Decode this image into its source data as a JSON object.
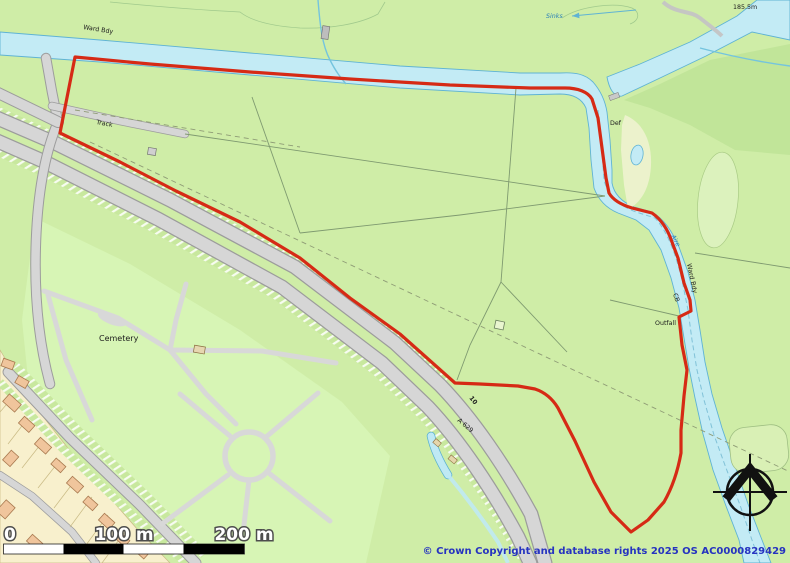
{
  "map": {
    "description": "Ordnance Survey style site plan with red application boundary along River Aire",
    "labels": {
      "ward_bdy_top": "Ward Bdy",
      "track": "Track",
      "sinks": "Sinks",
      "spot_height": "185.5m",
      "def": "Def",
      "river_name": "Aire",
      "ward_bdy_river": "Ward Bdy",
      "cb": "CB",
      "outfall": "Outfall",
      "cemetery": "Cemetery",
      "road_number": "A 629",
      "plot_number": "10"
    },
    "scale_bar": {
      "zero": "0",
      "mid": "100 m",
      "end": "200 m"
    },
    "copyright": "© Crown Copyright and database rights 2025 OS AC0000829429",
    "colors": {
      "field_green": "#cfeda7",
      "river_fill": "#c3ebf5",
      "river_edge": "#5fb3d4",
      "boundary_red": "#d62a15",
      "road_fill": "#d6d6d6",
      "road_casing": "#9c9c9c",
      "plot_cream": "#f8f0cd",
      "building_orange": "#f0c59c",
      "water_label_blue": "#2a7fb8",
      "copyright_blue": "#2633c0"
    }
  }
}
